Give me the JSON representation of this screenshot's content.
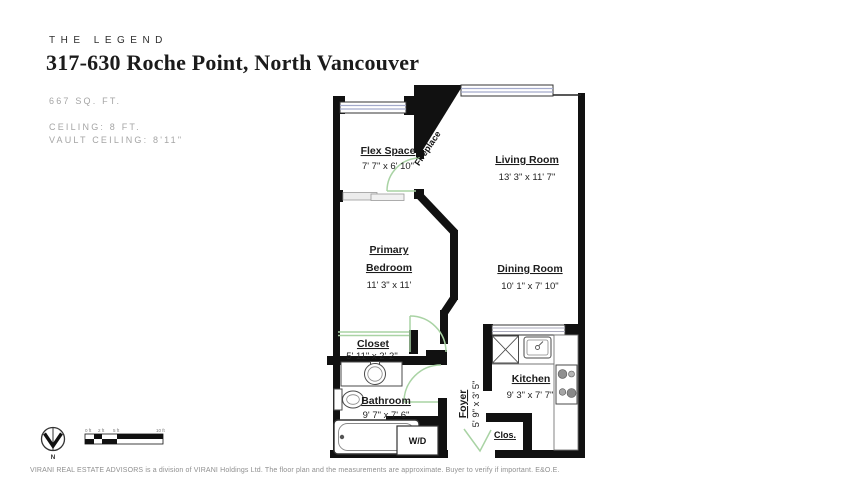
{
  "header": {
    "brand": "THE LEGEND",
    "title": "317-630 Roche Point, North Vancouver",
    "area": "667 SQ. FT.",
    "ceiling_lines": [
      "CEILING: 8 FT.",
      "VAULT CEILING: 8'11\""
    ]
  },
  "floorplan": {
    "rooms": {
      "flex": {
        "name": "Flex Space",
        "dims": "7' 7\" x 6' 10\""
      },
      "living": {
        "name": "Living Room",
        "dims": "13' 3\" x 11' 7\""
      },
      "primary": {
        "line1": "Primary",
        "line2": "Bedroom",
        "dims": "11' 3\" x 11'"
      },
      "dining": {
        "name": "Dining Room",
        "dims": "10' 1\" x 7' 10\""
      },
      "closet": {
        "name": "Closet",
        "dims": "5' 11\" x 2' 2\""
      },
      "bathroom": {
        "name": "Bathroom",
        "dims": "9' 7\" x 7' 6\""
      },
      "kitchen": {
        "name": "Kitchen",
        "dims": "9' 3\" x 7' 7\""
      },
      "foyer": {
        "name": "Foyer",
        "dims": "5' 9\" x 3' 5\""
      }
    },
    "features": {
      "fireplace": "Fireplace",
      "washer_dryer": "W/D",
      "closet_small": "Clos."
    },
    "colors": {
      "wall": "#111111",
      "window_glass": "#a3aacc",
      "door_swing": "#a9d3a4",
      "slider_gray": "#ececec"
    }
  },
  "footer": {
    "compass_label": "N",
    "scale_labels": [
      "0 ft",
      "2 ft",
      "5 ft",
      "10 ft"
    ],
    "disclaimer": "VIRANI REAL ESTATE ADVISORS is a division of VIRANI Holdings Ltd. The floor plan and the measurements are approximate. Buyer to verify if important. E&O.E."
  }
}
